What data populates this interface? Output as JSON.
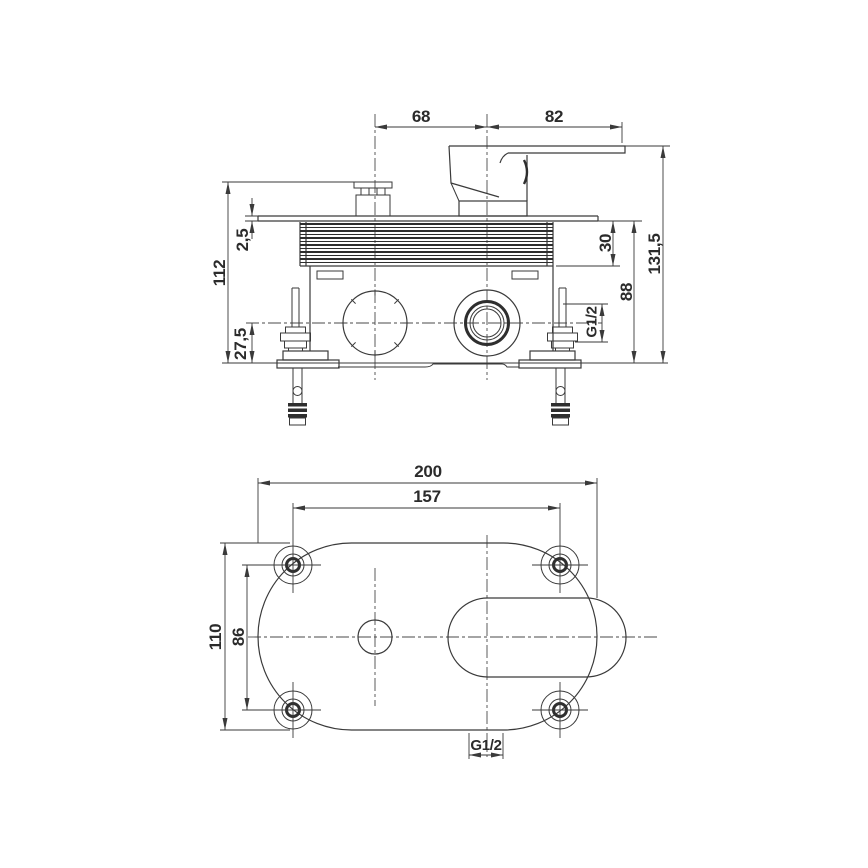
{
  "drawing": {
    "background": "#ffffff",
    "line_color": "#3a3a3a",
    "text_color": "#2b2b2b"
  },
  "side_view": {
    "dims": {
      "cartridge_to_handle_center": "68",
      "handle_center_to_lever_tip": "82",
      "total_height": "131,5",
      "plate_to_wall_height": "88",
      "plate_to_body_depth": "30",
      "plate_thickness": "2,5",
      "overall_install_depth": "112",
      "outlet_axis_to_wall": "27,5",
      "outlet_thread": "G1/2"
    }
  },
  "plan_view": {
    "dims": {
      "plate_length": "200",
      "screw_spacing_length": "157",
      "plate_width": "110",
      "screw_spacing_width": "86",
      "outlet_thread": "G1/2"
    }
  }
}
